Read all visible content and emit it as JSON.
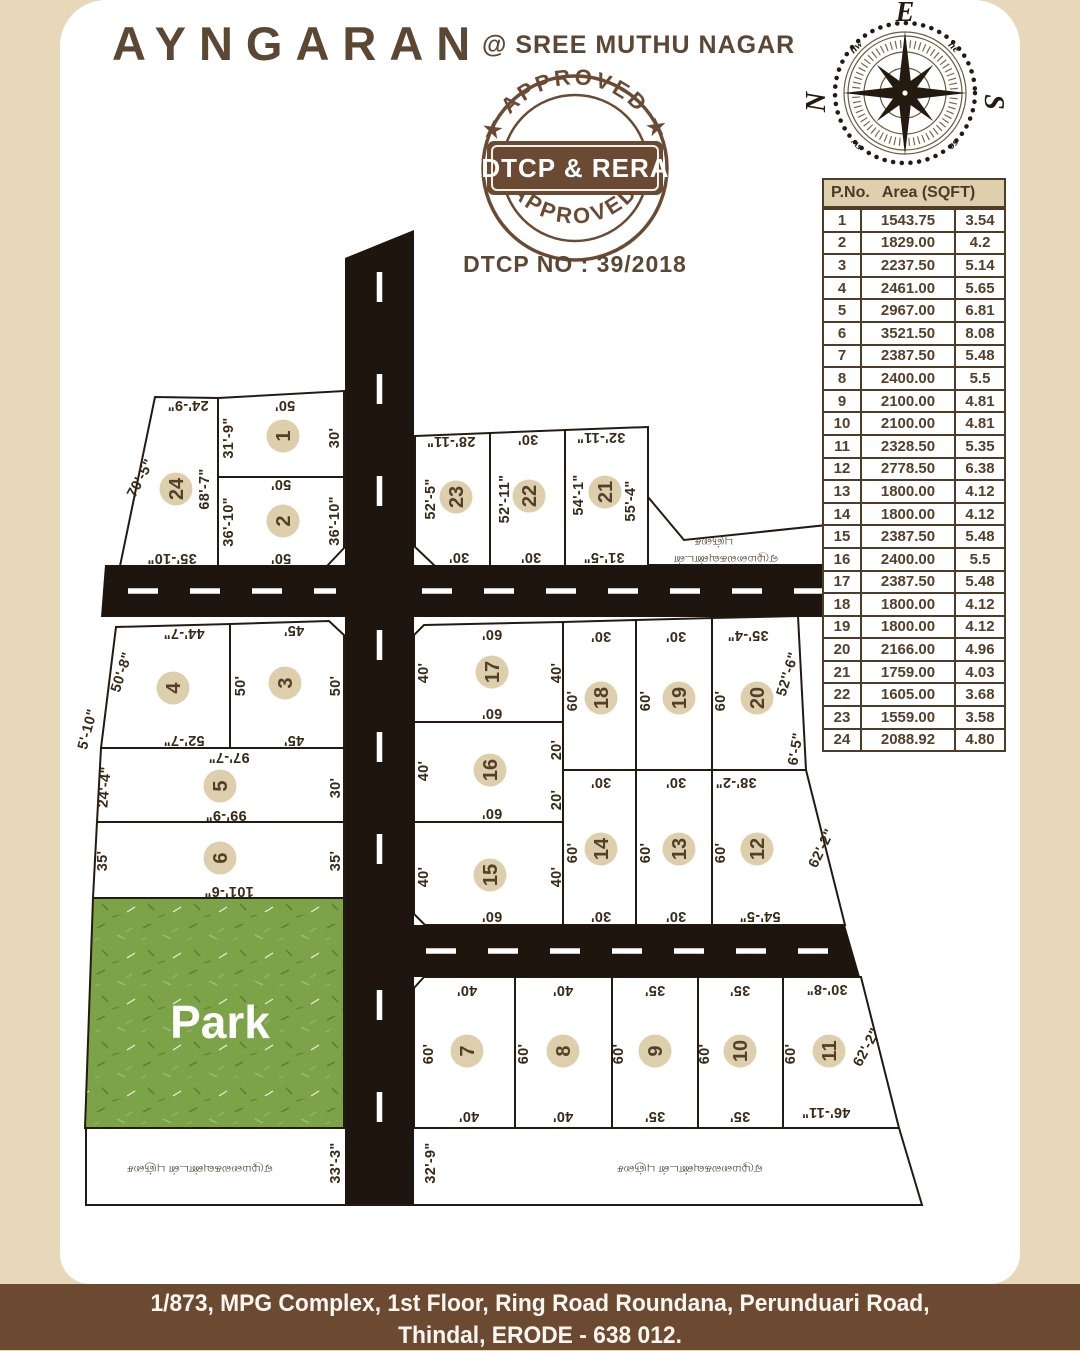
{
  "header": {
    "brand": "AYNGARAN",
    "location": "@ SREE MUTHU NAGAR"
  },
  "stamp": {
    "top_curved": "★ APPROVED ★",
    "bottom_curved": "★ APPROVED ★",
    "banner": "★ DTCP & RERA ★",
    "dtcp_no": "DTCP NO : 39/2018"
  },
  "compass": {
    "n": "N",
    "e": "E",
    "s": "S",
    "w": "W",
    "ne": "ne",
    "se": "se",
    "sw": "sw",
    "nw": "nw"
  },
  "table": {
    "col1": "P.No.",
    "col2": "Area (SQFT)",
    "rows": [
      [
        "1",
        "1543.75",
        "3.54"
      ],
      [
        "2",
        "1829.00",
        "4.2"
      ],
      [
        "3",
        "2237.50",
        "5.14"
      ],
      [
        "4",
        "2461.00",
        "5.65"
      ],
      [
        "5",
        "2967.00",
        "6.81"
      ],
      [
        "6",
        "3521.50",
        "8.08"
      ],
      [
        "7",
        "2387.50",
        "5.48"
      ],
      [
        "8",
        "2400.00",
        "5.5"
      ],
      [
        "9",
        "2100.00",
        "4.81"
      ],
      [
        "10",
        "2100.00",
        "4.81"
      ],
      [
        "11",
        "2328.50",
        "5.35"
      ],
      [
        "12",
        "2778.50",
        "6.38"
      ],
      [
        "13",
        "1800.00",
        "4.12"
      ],
      [
        "14",
        "1800.00",
        "4.12"
      ],
      [
        "15",
        "2387.50",
        "5.48"
      ],
      [
        "16",
        "2400.00",
        "5.5"
      ],
      [
        "17",
        "2387.50",
        "5.48"
      ],
      [
        "18",
        "1800.00",
        "4.12"
      ],
      [
        "19",
        "1800.00",
        "4.12"
      ],
      [
        "20",
        "2166.00",
        "4.96"
      ],
      [
        "21",
        "1759.00",
        "4.03"
      ],
      [
        "22",
        "1605.00",
        "3.68"
      ],
      [
        "23",
        "1559.00",
        "3.58"
      ],
      [
        "24",
        "2088.92",
        "4.80"
      ]
    ]
  },
  "footer": {
    "line1": "1/873, MPG Complex, 1st Floor, Ring Road Roundana, Perunduari Road,",
    "line2": "Thindal, ERODE - 638 012."
  },
  "map": {
    "plots": [
      {
        "n": "1",
        "x": 283,
        "y": 436
      },
      {
        "n": "2",
        "x": 283,
        "y": 521
      },
      {
        "n": "3",
        "x": 285,
        "y": 683
      },
      {
        "n": "4",
        "x": 173,
        "y": 688
      },
      {
        "n": "5",
        "x": 220,
        "y": 786
      },
      {
        "n": "6",
        "x": 220,
        "y": 858
      },
      {
        "n": "7",
        "x": 467,
        "y": 1051
      },
      {
        "n": "8",
        "x": 563,
        "y": 1051
      },
      {
        "n": "9",
        "x": 655,
        "y": 1051
      },
      {
        "n": "10",
        "x": 740,
        "y": 1051
      },
      {
        "n": "11",
        "x": 829,
        "y": 1051
      },
      {
        "n": "12",
        "x": 757,
        "y": 849
      },
      {
        "n": "13",
        "x": 679,
        "y": 849
      },
      {
        "n": "14",
        "x": 601,
        "y": 849
      },
      {
        "n": "15",
        "x": 490,
        "y": 875
      },
      {
        "n": "16",
        "x": 490,
        "y": 770
      },
      {
        "n": "17",
        "x": 492,
        "y": 672
      },
      {
        "n": "18",
        "x": 601,
        "y": 698
      },
      {
        "n": "19",
        "x": 679,
        "y": 698
      },
      {
        "n": "20",
        "x": 757,
        "y": 698
      },
      {
        "n": "21",
        "x": 605,
        "y": 492
      },
      {
        "n": "22",
        "x": 529,
        "y": 496
      },
      {
        "n": "23",
        "x": 456,
        "y": 497
      },
      {
        "n": "24",
        "x": 176,
        "y": 489
      }
    ],
    "labels": [
      {
        "t": "24'-9\"",
        "x": 188,
        "y": 406,
        "r": 180
      },
      {
        "t": "70'-5\"",
        "x": 140,
        "y": 478,
        "r": -62
      },
      {
        "t": "68'-7\"",
        "x": 204,
        "y": 489,
        "r": -90
      },
      {
        "t": "31'-9\"",
        "x": 228,
        "y": 438,
        "r": -90
      },
      {
        "t": "50'",
        "x": 285,
        "y": 406,
        "r": 180
      },
      {
        "t": "30'",
        "x": 334,
        "y": 438,
        "r": -90
      },
      {
        "t": "50'",
        "x": 281,
        "y": 485,
        "r": 180
      },
      {
        "t": "36'-10\"",
        "x": 228,
        "y": 522,
        "r": -90
      },
      {
        "t": "36'-10\"",
        "x": 334,
        "y": 521,
        "r": -90
      },
      {
        "t": "50'",
        "x": 281,
        "y": 559,
        "r": 180
      },
      {
        "t": "35'-10\"",
        "x": 172,
        "y": 559,
        "r": 180
      },
      {
        "t": "28'-11\"",
        "x": 451,
        "y": 442,
        "r": 180
      },
      {
        "t": "52'-5\"",
        "x": 430,
        "y": 499,
        "r": -90
      },
      {
        "t": "30'",
        "x": 459,
        "y": 558,
        "r": 180
      },
      {
        "t": "30'",
        "x": 528,
        "y": 440,
        "r": 180
      },
      {
        "t": "52'-11\"",
        "x": 504,
        "y": 499,
        "r": -90
      },
      {
        "t": "30'",
        "x": 531,
        "y": 558,
        "r": 180
      },
      {
        "t": "32'-11\"",
        "x": 601,
        "y": 438,
        "r": 180
      },
      {
        "t": "54'-1\"",
        "x": 578,
        "y": 495,
        "r": -90
      },
      {
        "t": "55'-4\"",
        "x": 630,
        "y": 501,
        "r": -90
      },
      {
        "t": "31'-5\"",
        "x": 604,
        "y": 558,
        "r": 180
      },
      {
        "t": "1'-4\"",
        "x": 857,
        "y": 593,
        "r": -90
      },
      {
        "t": "44'-7\"",
        "x": 184,
        "y": 634,
        "r": 180
      },
      {
        "t": "50'-8\"",
        "x": 121,
        "y": 672,
        "r": -72
      },
      {
        "t": "5'-10\"",
        "x": 87,
        "y": 729,
        "r": -75
      },
      {
        "t": "52'-7\"",
        "x": 184,
        "y": 741,
        "r": 180
      },
      {
        "t": "45'",
        "x": 294,
        "y": 631,
        "r": 180
      },
      {
        "t": "50'",
        "x": 240,
        "y": 686,
        "r": -90
      },
      {
        "t": "50'",
        "x": 335,
        "y": 686,
        "r": -90
      },
      {
        "t": "45'",
        "x": 294,
        "y": 741,
        "r": 180
      },
      {
        "t": "97'-7\"",
        "x": 229,
        "y": 758,
        "r": 180
      },
      {
        "t": "24'-4\"",
        "x": 104,
        "y": 787,
        "r": -85
      },
      {
        "t": "30'",
        "x": 335,
        "y": 788,
        "r": -90
      },
      {
        "t": "99'-9\"",
        "x": 226,
        "y": 816,
        "r": 180
      },
      {
        "t": "35'",
        "x": 102,
        "y": 861,
        "r": -90
      },
      {
        "t": "35'",
        "x": 335,
        "y": 861,
        "r": -90
      },
      {
        "t": "101'-6\"",
        "x": 229,
        "y": 892,
        "r": 180
      },
      {
        "t": "60'",
        "x": 492,
        "y": 635,
        "r": 180
      },
      {
        "t": "40'",
        "x": 423,
        "y": 673,
        "r": -90
      },
      {
        "t": "40'",
        "x": 556,
        "y": 673,
        "r": -90
      },
      {
        "t": "60'",
        "x": 492,
        "y": 714,
        "r": 180
      },
      {
        "t": "40'",
        "x": 423,
        "y": 771,
        "r": -90
      },
      {
        "t": "20'",
        "x": 556,
        "y": 750,
        "r": -90
      },
      {
        "t": "20'",
        "x": 556,
        "y": 800,
        "r": -90
      },
      {
        "t": "60'",
        "x": 492,
        "y": 814,
        "r": 180
      },
      {
        "t": "40'",
        "x": 423,
        "y": 877,
        "r": -90
      },
      {
        "t": "40'",
        "x": 556,
        "y": 877,
        "r": -90
      },
      {
        "t": "60'",
        "x": 492,
        "y": 917,
        "r": 180
      },
      {
        "t": "30'",
        "x": 601,
        "y": 637,
        "r": 180
      },
      {
        "t": "60'",
        "x": 572,
        "y": 701,
        "r": -90
      },
      {
        "t": "30'",
        "x": 676,
        "y": 637,
        "r": 180
      },
      {
        "t": "60'",
        "x": 645,
        "y": 701,
        "r": -90
      },
      {
        "t": "35'-4\"",
        "x": 748,
        "y": 636,
        "r": 180
      },
      {
        "t": "60'",
        "x": 720,
        "y": 701,
        "r": -90
      },
      {
        "t": "52''-6\"",
        "x": 787,
        "y": 674,
        "r": -73
      },
      {
        "t": "6'-5\"",
        "x": 795,
        "y": 749,
        "r": -80
      },
      {
        "t": "30'",
        "x": 601,
        "y": 783,
        "r": 180
      },
      {
        "t": "60'",
        "x": 572,
        "y": 853,
        "r": -90
      },
      {
        "t": "30'",
        "x": 601,
        "y": 917,
        "r": 180
      },
      {
        "t": "30'",
        "x": 676,
        "y": 783,
        "r": 180
      },
      {
        "t": "60'",
        "x": 645,
        "y": 853,
        "r": -90
      },
      {
        "t": "30'",
        "x": 676,
        "y": 917,
        "r": 180
      },
      {
        "t": "38'-2\"",
        "x": 736,
        "y": 783,
        "r": 180
      },
      {
        "t": "60'",
        "x": 720,
        "y": 853,
        "r": -90
      },
      {
        "t": "62'-2\"",
        "x": 821,
        "y": 848,
        "r": -64
      },
      {
        "t": "54'-5\"",
        "x": 760,
        "y": 917,
        "r": 180
      },
      {
        "t": "40'",
        "x": 467,
        "y": 991,
        "r": 180
      },
      {
        "t": "60'",
        "x": 428,
        "y": 1054,
        "r": -90
      },
      {
        "t": "40'",
        "x": 469,
        "y": 1117,
        "r": 180
      },
      {
        "t": "40'",
        "x": 563,
        "y": 991,
        "r": 180
      },
      {
        "t": "60'",
        "x": 523,
        "y": 1054,
        "r": -90
      },
      {
        "t": "40'",
        "x": 563,
        "y": 1117,
        "r": 180
      },
      {
        "t": "35'",
        "x": 655,
        "y": 991,
        "r": 180
      },
      {
        "t": "60'",
        "x": 618,
        "y": 1054,
        "r": -90
      },
      {
        "t": "35'",
        "x": 655,
        "y": 1117,
        "r": 180
      },
      {
        "t": "35'",
        "x": 740,
        "y": 991,
        "r": 180
      },
      {
        "t": "60'",
        "x": 704,
        "y": 1054,
        "r": -90
      },
      {
        "t": "35'",
        "x": 740,
        "y": 1117,
        "r": 180
      },
      {
        "t": "30'-8\"",
        "x": 827,
        "y": 990,
        "r": 180
      },
      {
        "t": "60'",
        "x": 790,
        "y": 1054,
        "r": -90
      },
      {
        "t": "46'-11\"",
        "x": 826,
        "y": 1113,
        "r": 180
      },
      {
        "t": "62'-2\"",
        "x": 866,
        "y": 1047,
        "r": -62
      },
      {
        "t": "33'-3\"",
        "x": 335,
        "y": 1163,
        "r": -90
      },
      {
        "t": "32'-9\"",
        "x": 430,
        "y": 1163,
        "r": -90
      },
      {
        "t": "புஞ்சை",
        "x": 714,
        "y": 543,
        "r": 180,
        "c": "tamil",
        "n": "boundary-label-tamil"
      },
      {
        "t": "ஏழுமலைகவுண்டன்",
        "x": 726,
        "y": 560,
        "r": 180,
        "c": "tamil",
        "n": "boundary-label-tamil"
      },
      {
        "t": "ஏழுமலைகவுண்டன் புஞ்சை",
        "x": 200,
        "y": 1170,
        "r": 180,
        "c": "tamil",
        "n": "boundary-label-tamil"
      },
      {
        "t": "ஏழுமலைகவுண்டன் புஞ்சை",
        "x": 690,
        "y": 1170,
        "r": 180,
        "c": "tamil",
        "n": "boundary-label-tamil"
      },
      {
        "t": "Park",
        "x": 220,
        "y": 1022,
        "r": 0,
        "c": "park-label",
        "n": "park-label"
      }
    ]
  },
  "colors": {
    "page_beige": "#e7d8ba",
    "card_white": "#ffffff",
    "road_black": "#1d150e",
    "park_green": "#7da348",
    "brand_brown": "#5b4733",
    "footer_brown": "#6b4a31",
    "circle_beige": "#ddcfab",
    "table_header_beige": "#decfad"
  }
}
